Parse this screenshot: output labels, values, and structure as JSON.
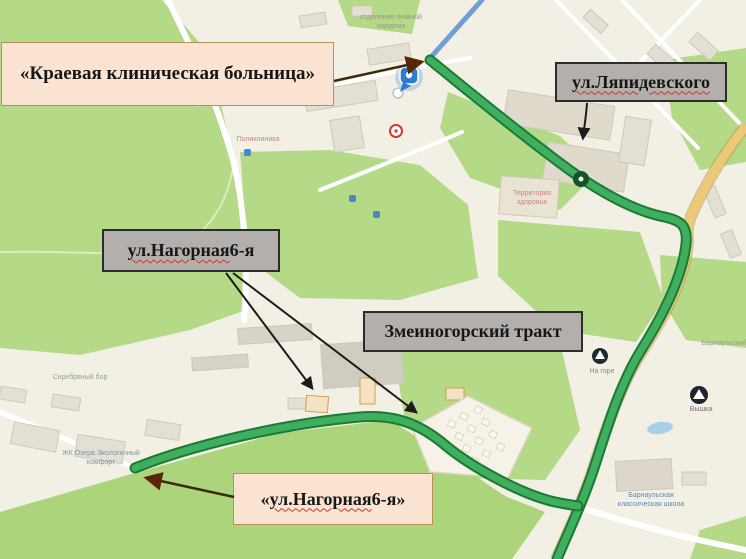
{
  "callouts": {
    "hospital": {
      "text": "«Краевая клиническая больница»"
    },
    "lyapidevskogo": {
      "text": "ул.Ляпидевского"
    },
    "nagornaya": {
      "main": "ул.Нагорная",
      "suffix": " 6-я"
    },
    "zmeinogorskiy": {
      "text": "Змеиногорский тракт"
    },
    "nagornaya_quoted": {
      "open": "«",
      "main": "ул.Нагорная",
      "suffix": " 6-я»"
    }
  },
  "map": {
    "texts": [
      {
        "text": "отделение гнойной хирургии"
      },
      {
        "text": "Поликлиника"
      },
      {
        "text": "Территория здоровья"
      },
      {
        "text": "Серебряный бор"
      },
      {
        "text": "ЖК Озера Экологичный комфорт"
      },
      {
        "text": "Барнаульская классическая школа"
      },
      {
        "text": "На горе"
      },
      {
        "text": "Вышка"
      },
      {
        "text": "Барнаульский"
      }
    ],
    "icons": {
      "hospital_marker": "blue-map-pin",
      "location_dot": "white-circle",
      "route_stop": "dark-green-circle",
      "mount_poi": "dark-circle-mountain",
      "tower_poi": "dark-circle-mountain",
      "shop_poi": "red-ring-circle",
      "transit_poi": "blue-square"
    },
    "colors": {
      "background": "#f2efe5",
      "park_green": "#b4d987",
      "route_green": "#2fa14c",
      "route_casing": "#1b7a33",
      "highway_yellow": "#ecc978",
      "construction_blue": "#6f9fd4",
      "callout_gray_bg": "#b3afac",
      "callout_cream_bg": "#fae3d1",
      "arrow_black": "#1c1c1c",
      "arrow_brown": "#5a2607",
      "squiggle_red": "#c43a2e"
    }
  }
}
